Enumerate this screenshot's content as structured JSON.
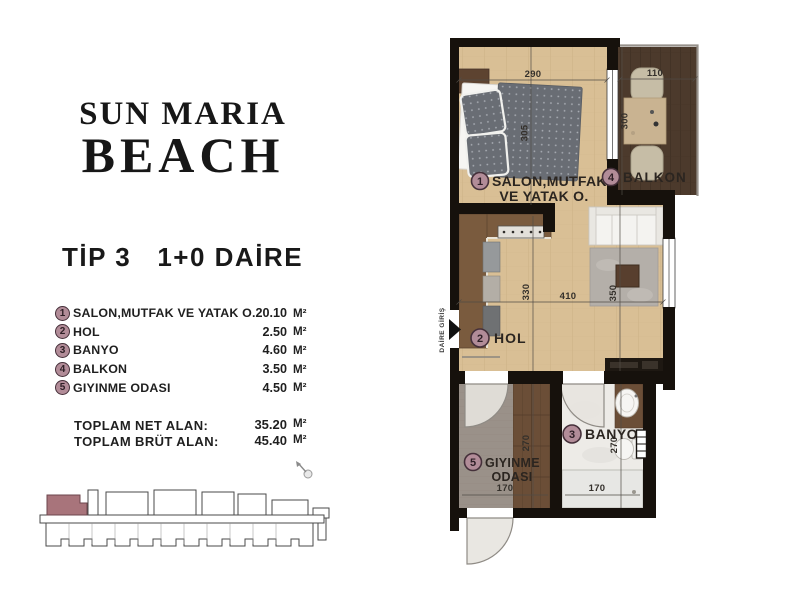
{
  "brand": {
    "line1": "SUN MARIA",
    "line2": "BEACH"
  },
  "unit_type": "TİP 3   1+0 DAİRE",
  "legend": {
    "rooms": [
      {
        "num": "1",
        "name": "SALON,MUTFAK VE YATAK O.",
        "area": "20.10",
        "unit": "M²"
      },
      {
        "num": "2",
        "name": "HOL",
        "area": "2.50",
        "unit": "M²"
      },
      {
        "num": "3",
        "name": "BANYO",
        "area": "4.60",
        "unit": "M²"
      },
      {
        "num": "4",
        "name": "BALKON",
        "area": "3.50",
        "unit": "M²"
      },
      {
        "num": "5",
        "name": "GIYINME ODASI",
        "area": "4.50",
        "unit": "M²"
      }
    ],
    "totals": [
      {
        "label": "TOPLAM NET ALAN:",
        "value": "35.20",
        "unit": "M²"
      },
      {
        "label": "TOPLAM BRÜT ALAN:",
        "value": "45.40",
        "unit": "M²"
      }
    ]
  },
  "floorplan": {
    "entrance_label": "DAİRE GİRİŞ",
    "labels": {
      "salon_num": "1",
      "salon_line1": "SALON,MUTFAK",
      "salon_line2": "VE YATAK O.",
      "hol_num": "2",
      "hol": "HOL",
      "banyo_num": "3",
      "banyo": "BANYO",
      "balkon_num": "4",
      "balkon": "BALKON",
      "giyinme_num": "5",
      "giyinme_line1": "GIYINME",
      "giyinme_line2": "ODASI"
    },
    "dimensions": {
      "salon_width": "290",
      "balcony_width": "110",
      "balcony_depth": "300",
      "bed_length": "305",
      "salon_depth": "330",
      "hol_width": "410",
      "living_depth": "350",
      "giyinme_depth": "270",
      "giyinme_width": "170",
      "banyo_depth": "270",
      "banyo_width": "170"
    }
  },
  "colors": {
    "accent_badge": "#b28c98",
    "highlighted_unit": "#a8747b",
    "wall": "#16110c",
    "wood_floor": "#d9bf95",
    "balcony_floor": "#4c3a2c",
    "dressing_floor": "#9a9189"
  }
}
